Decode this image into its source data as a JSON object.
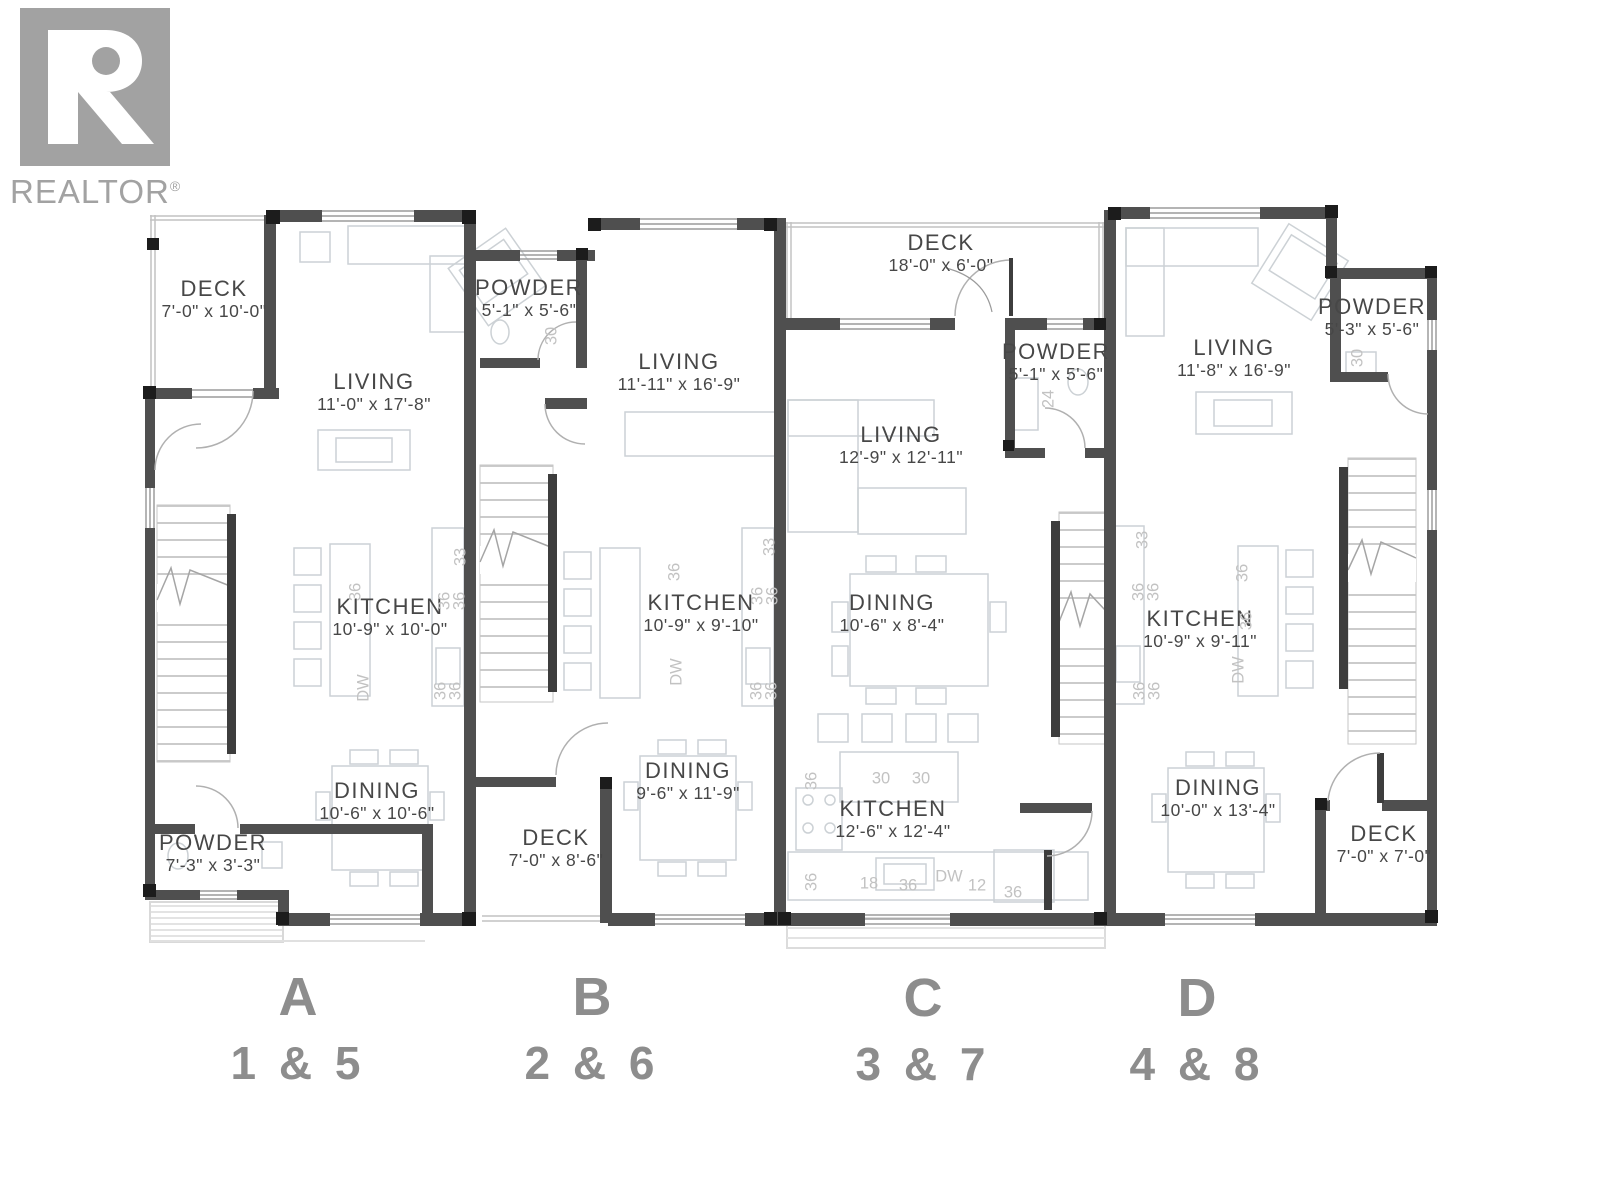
{
  "logo": {
    "brand": "REALTOR",
    "reg": "®"
  },
  "units": [
    {
      "letter": "A",
      "numbers": "1 & 5",
      "rooms": {
        "deck": {
          "name": "DECK",
          "dims": "7'-0\" x 10'-0\""
        },
        "living": {
          "name": "LIVING",
          "dims": "11'-0\" x 17'-8\""
        },
        "kitchen": {
          "name": "KITCHEN",
          "dims": "10'-9\" x 10'-0\""
        },
        "dining": {
          "name": "DINING",
          "dims": "10'-6\" x 10'-6\""
        },
        "powder": {
          "name": "POWDER",
          "dims": "7'-3\" x 3'-3\""
        }
      },
      "annotations": [
        "36",
        "33",
        "36",
        "36",
        "DW",
        "36",
        "36"
      ]
    },
    {
      "letter": "B",
      "numbers": "2 & 6",
      "rooms": {
        "powder": {
          "name": "POWDER",
          "dims": "5'-1\" x 5'-6\""
        },
        "living": {
          "name": "LIVING",
          "dims": "11'-11\" x 16'-9\""
        },
        "kitchen": {
          "name": "KITCHEN",
          "dims": "10'-9\" x 9'-10\""
        },
        "dining": {
          "name": "DINING",
          "dims": "9'-6\" x 11'-9\""
        },
        "deck": {
          "name": "DECK",
          "dims": "7'-0\" x 8'-6\""
        }
      },
      "annotations": [
        "30",
        "36",
        "33",
        "36",
        "36",
        "DW",
        "36",
        "36"
      ]
    },
    {
      "letter": "C",
      "numbers": "3 & 7",
      "rooms": {
        "deck": {
          "name": "DECK",
          "dims": "18'-0\" x 6'-0\""
        },
        "powder": {
          "name": "POWDER",
          "dims": "5'-1\" x 5'-6\""
        },
        "living": {
          "name": "LIVING",
          "dims": "12'-9\" x 12'-11\""
        },
        "dining": {
          "name": "DINING",
          "dims": "10'-6\" x 8'-4\""
        },
        "kitchen": {
          "name": "KITCHEN",
          "dims": "12'-6\" x 12'-4\""
        }
      },
      "annotations": [
        "24",
        "36",
        "30",
        "30",
        "36",
        "18",
        "36",
        "DW",
        "12",
        "36"
      ]
    },
    {
      "letter": "D",
      "numbers": "4 & 8",
      "rooms": {
        "living": {
          "name": "LIVING",
          "dims": "11'-8\" x 16'-9\""
        },
        "powder": {
          "name": "POWDER",
          "dims": "5'-3\" x 5'-6\""
        },
        "kitchen": {
          "name": "KITCHEN",
          "dims": "10'-9\" x 9'-11\""
        },
        "dining": {
          "name": "DINING",
          "dims": "10'-0\" x 13'-4\""
        },
        "deck": {
          "name": "DECK",
          "dims": "7'-0\" x 7'-0\""
        }
      },
      "annotations": [
        "30",
        "33",
        "36",
        "36",
        "36",
        "36",
        "DW",
        "36",
        "36"
      ]
    }
  ],
  "colors": {
    "wall": "#4f4f4f",
    "corner_black": "#1c1c1c",
    "furniture": "#ccd1d5",
    "stair_tread": "#cbcbcb",
    "handrail": "#3d3d3d",
    "room_text": "#474747",
    "annotation_text": "#c2c2c2",
    "unit_label_text": "#8d8d8d",
    "logo_gray": "#a2a2a2"
  }
}
